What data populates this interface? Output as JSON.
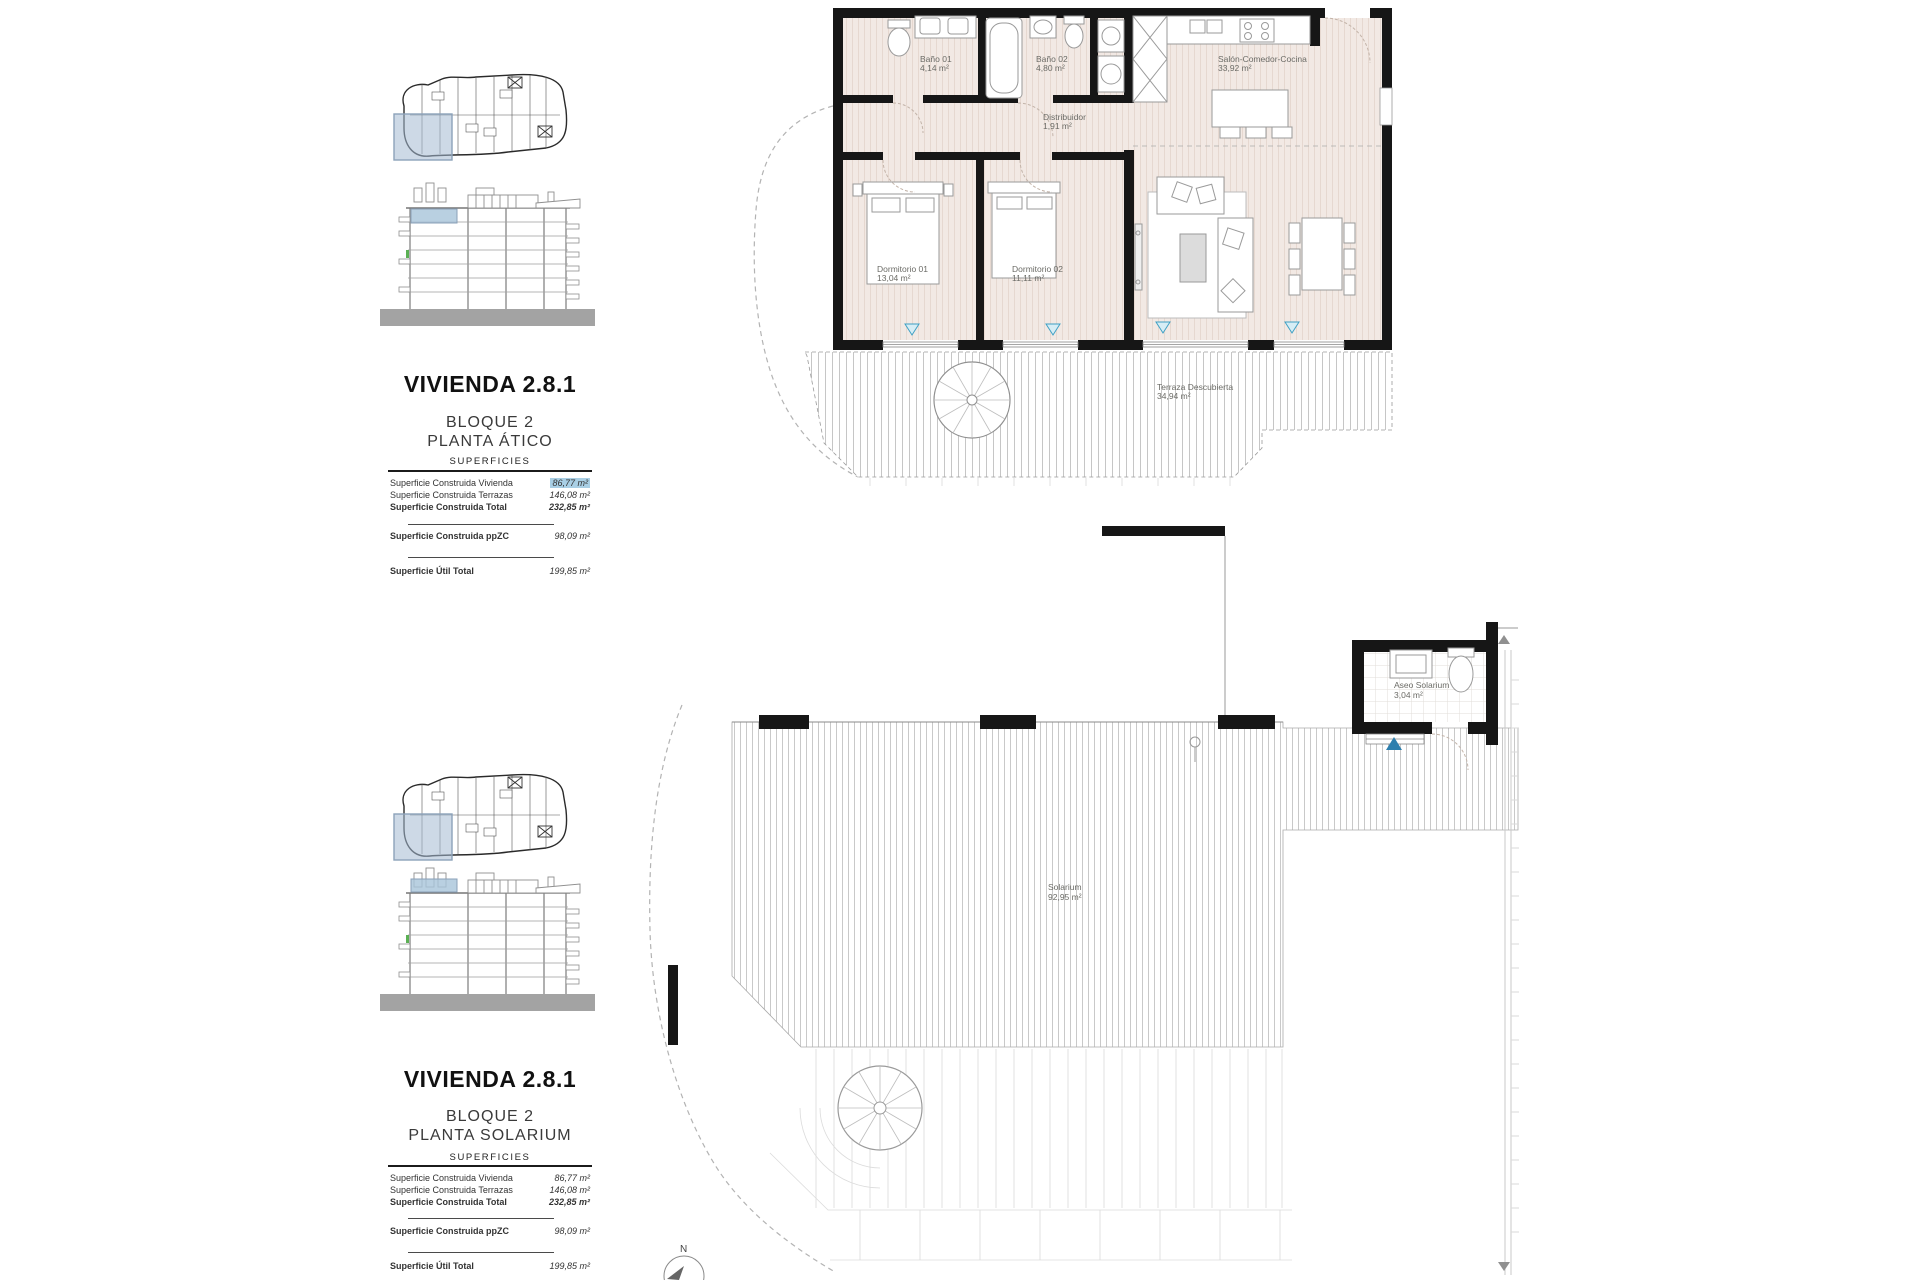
{
  "document": {
    "sections": [
      {
        "title": "VIVIENDA 2.8.1",
        "block": "BLOQUE 2",
        "floor": "PLANTA ÁTICO",
        "surfaces_header": "SUPERFICIES",
        "rows": [
          {
            "label": "Superficie Construida Vivienda",
            "value": "86,77 m²"
          },
          {
            "label": "Superficie Construida Terrazas",
            "value": "146,08 m²"
          },
          {
            "label": "Superficie Construida Total",
            "value": "232,85 m²"
          },
          {
            "label": "Superficie Construida ppZC",
            "value": "98,09 m²"
          },
          {
            "label": "Superficie Útil Total",
            "value": "199,85 m²"
          }
        ],
        "rooms": {
          "bano01": {
            "name": "Baño 01",
            "area": "4,14 m²"
          },
          "bano02": {
            "name": "Baño 02",
            "area": "4,80 m²"
          },
          "salon": {
            "name": "Salón-Comedor-Cocina",
            "area": "33,92 m²"
          },
          "distribuidor": {
            "name": "Distribuidor",
            "area": "1,91 m²"
          },
          "dorm01": {
            "name": "Dormitorio 01",
            "area": "13,04 m²"
          },
          "dorm02": {
            "name": "Dormitorio 02",
            "area": "11,11 m²"
          },
          "terraza": {
            "name": "Terraza Descubierta",
            "area": "34,94 m²"
          }
        }
      },
      {
        "title": "VIVIENDA 2.8.1",
        "block": "BLOQUE 2",
        "floor": "PLANTA SOLARIUM",
        "surfaces_header": "SUPERFICIES",
        "rows": [
          {
            "label": "Superficie Construida Vivienda",
            "value": "86,77 m²"
          },
          {
            "label": "Superficie Construida Terrazas",
            "value": "146,08 m²"
          },
          {
            "label": "Superficie Construida Total",
            "value": "232,85 m²"
          },
          {
            "label": "Superficie Construida ppZC",
            "value": "98,09 m²"
          },
          {
            "label": "Superficie Útil Total",
            "value": "199,85 m²"
          }
        ],
        "rooms": {
          "solarium": {
            "name": "Solarium",
            "area": "92,95 m²"
          },
          "aseo": {
            "name": "Aseo Solarium",
            "area": "3,04 m²"
          }
        },
        "compass": "N"
      }
    ],
    "colors": {
      "selection_highlight": "#a9cfe5",
      "keyplan_highlight": "#b9c9da",
      "marker_blue": "#3fa0c4"
    }
  }
}
